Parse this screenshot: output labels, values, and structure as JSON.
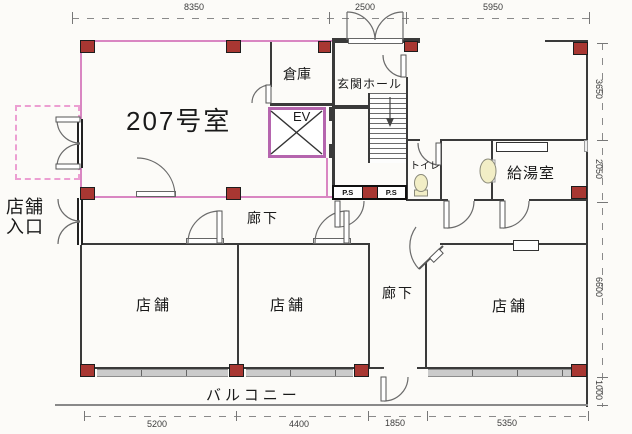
{
  "plan": {
    "rooms": {
      "room207": "207号室",
      "storage": "倉庫",
      "entrance_hall": "玄関ホール",
      "elevator": "EV",
      "toilet": "トイレ",
      "kitchenette": "給湯室",
      "corridor_upper": "廊下",
      "corridor_lower": "廊下",
      "shop1": "店舗",
      "shop2": "店舗",
      "shop3": "店舗",
      "shop_entrance_line1": "店舗",
      "shop_entrance_line2": "入口",
      "balcony": "バルコニー",
      "pipe_space_left": "P.S",
      "pipe_space_right": "P.S"
    },
    "dimensions": {
      "top": [
        "8350",
        "2500",
        "5950"
      ],
      "bottom": [
        "5200",
        "4400",
        "1850",
        "5350"
      ],
      "right": [
        "3650",
        "2050",
        "6600",
        "1000"
      ]
    },
    "colors": {
      "unit_outline_pink": "#d986c2",
      "column_red": "#a83732",
      "elevator_frame": "#b565ae",
      "fixture_cream": "#f2eec6",
      "window_gray": "#cbcbcb"
    }
  }
}
